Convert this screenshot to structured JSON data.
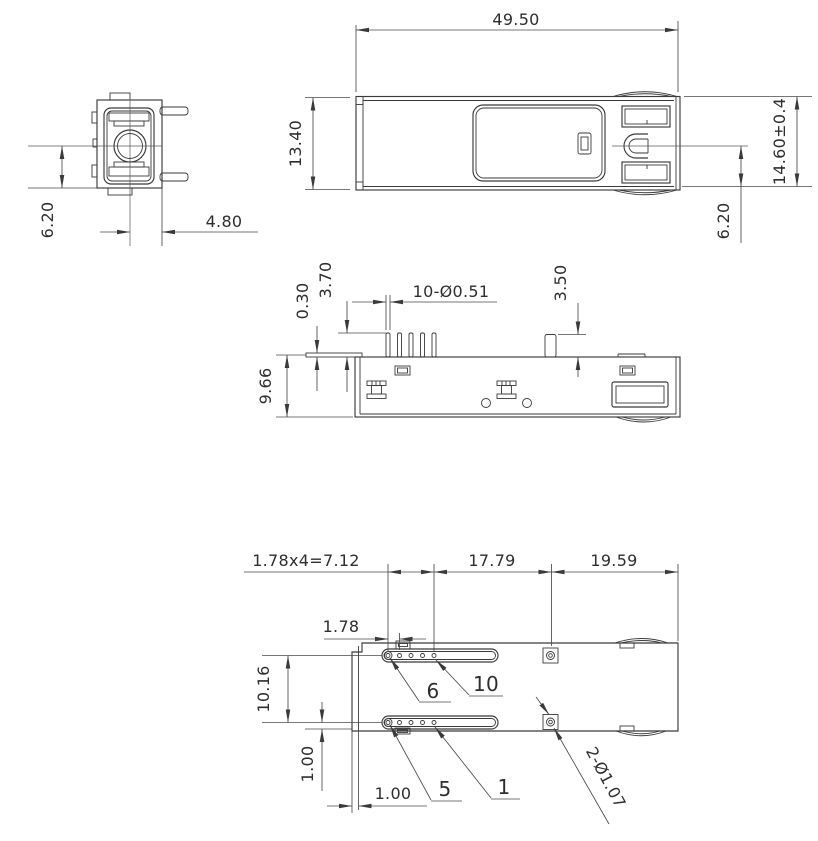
{
  "drawing": {
    "colors": {
      "background": "#ffffff",
      "lines": "#3a3a3a",
      "text": "#2e2e2e"
    },
    "views": {
      "end_view": {
        "dims": {
          "center_height": "6.20",
          "center_offset": "4.80"
        }
      },
      "top_view": {
        "dims": {
          "length": "49.50",
          "width": "13.40",
          "overall_height": "14.60±0.4",
          "latch_offset": "6.20"
        }
      },
      "side_view": {
        "dims": {
          "lip_thickness": "0.30",
          "pin_height": "3.70",
          "pin_diameter": "10-Ø0.51",
          "post_height": "3.50",
          "body_height": "9.66"
        }
      },
      "bottom_view": {
        "dims": {
          "pin_pitch_total": "1.78x4=7.12",
          "center_span": "17.79",
          "rear_span": "19.59",
          "pin_pitch": "1.78",
          "row_spacing": "10.16",
          "row_edge_offset": "1.00",
          "side_edge_offset": "1.00",
          "post_holes": "2-Ø1.07"
        },
        "pin_labels": {
          "pin6": "6",
          "pin10": "10",
          "pin5": "5",
          "pin1": "1"
        }
      }
    }
  }
}
